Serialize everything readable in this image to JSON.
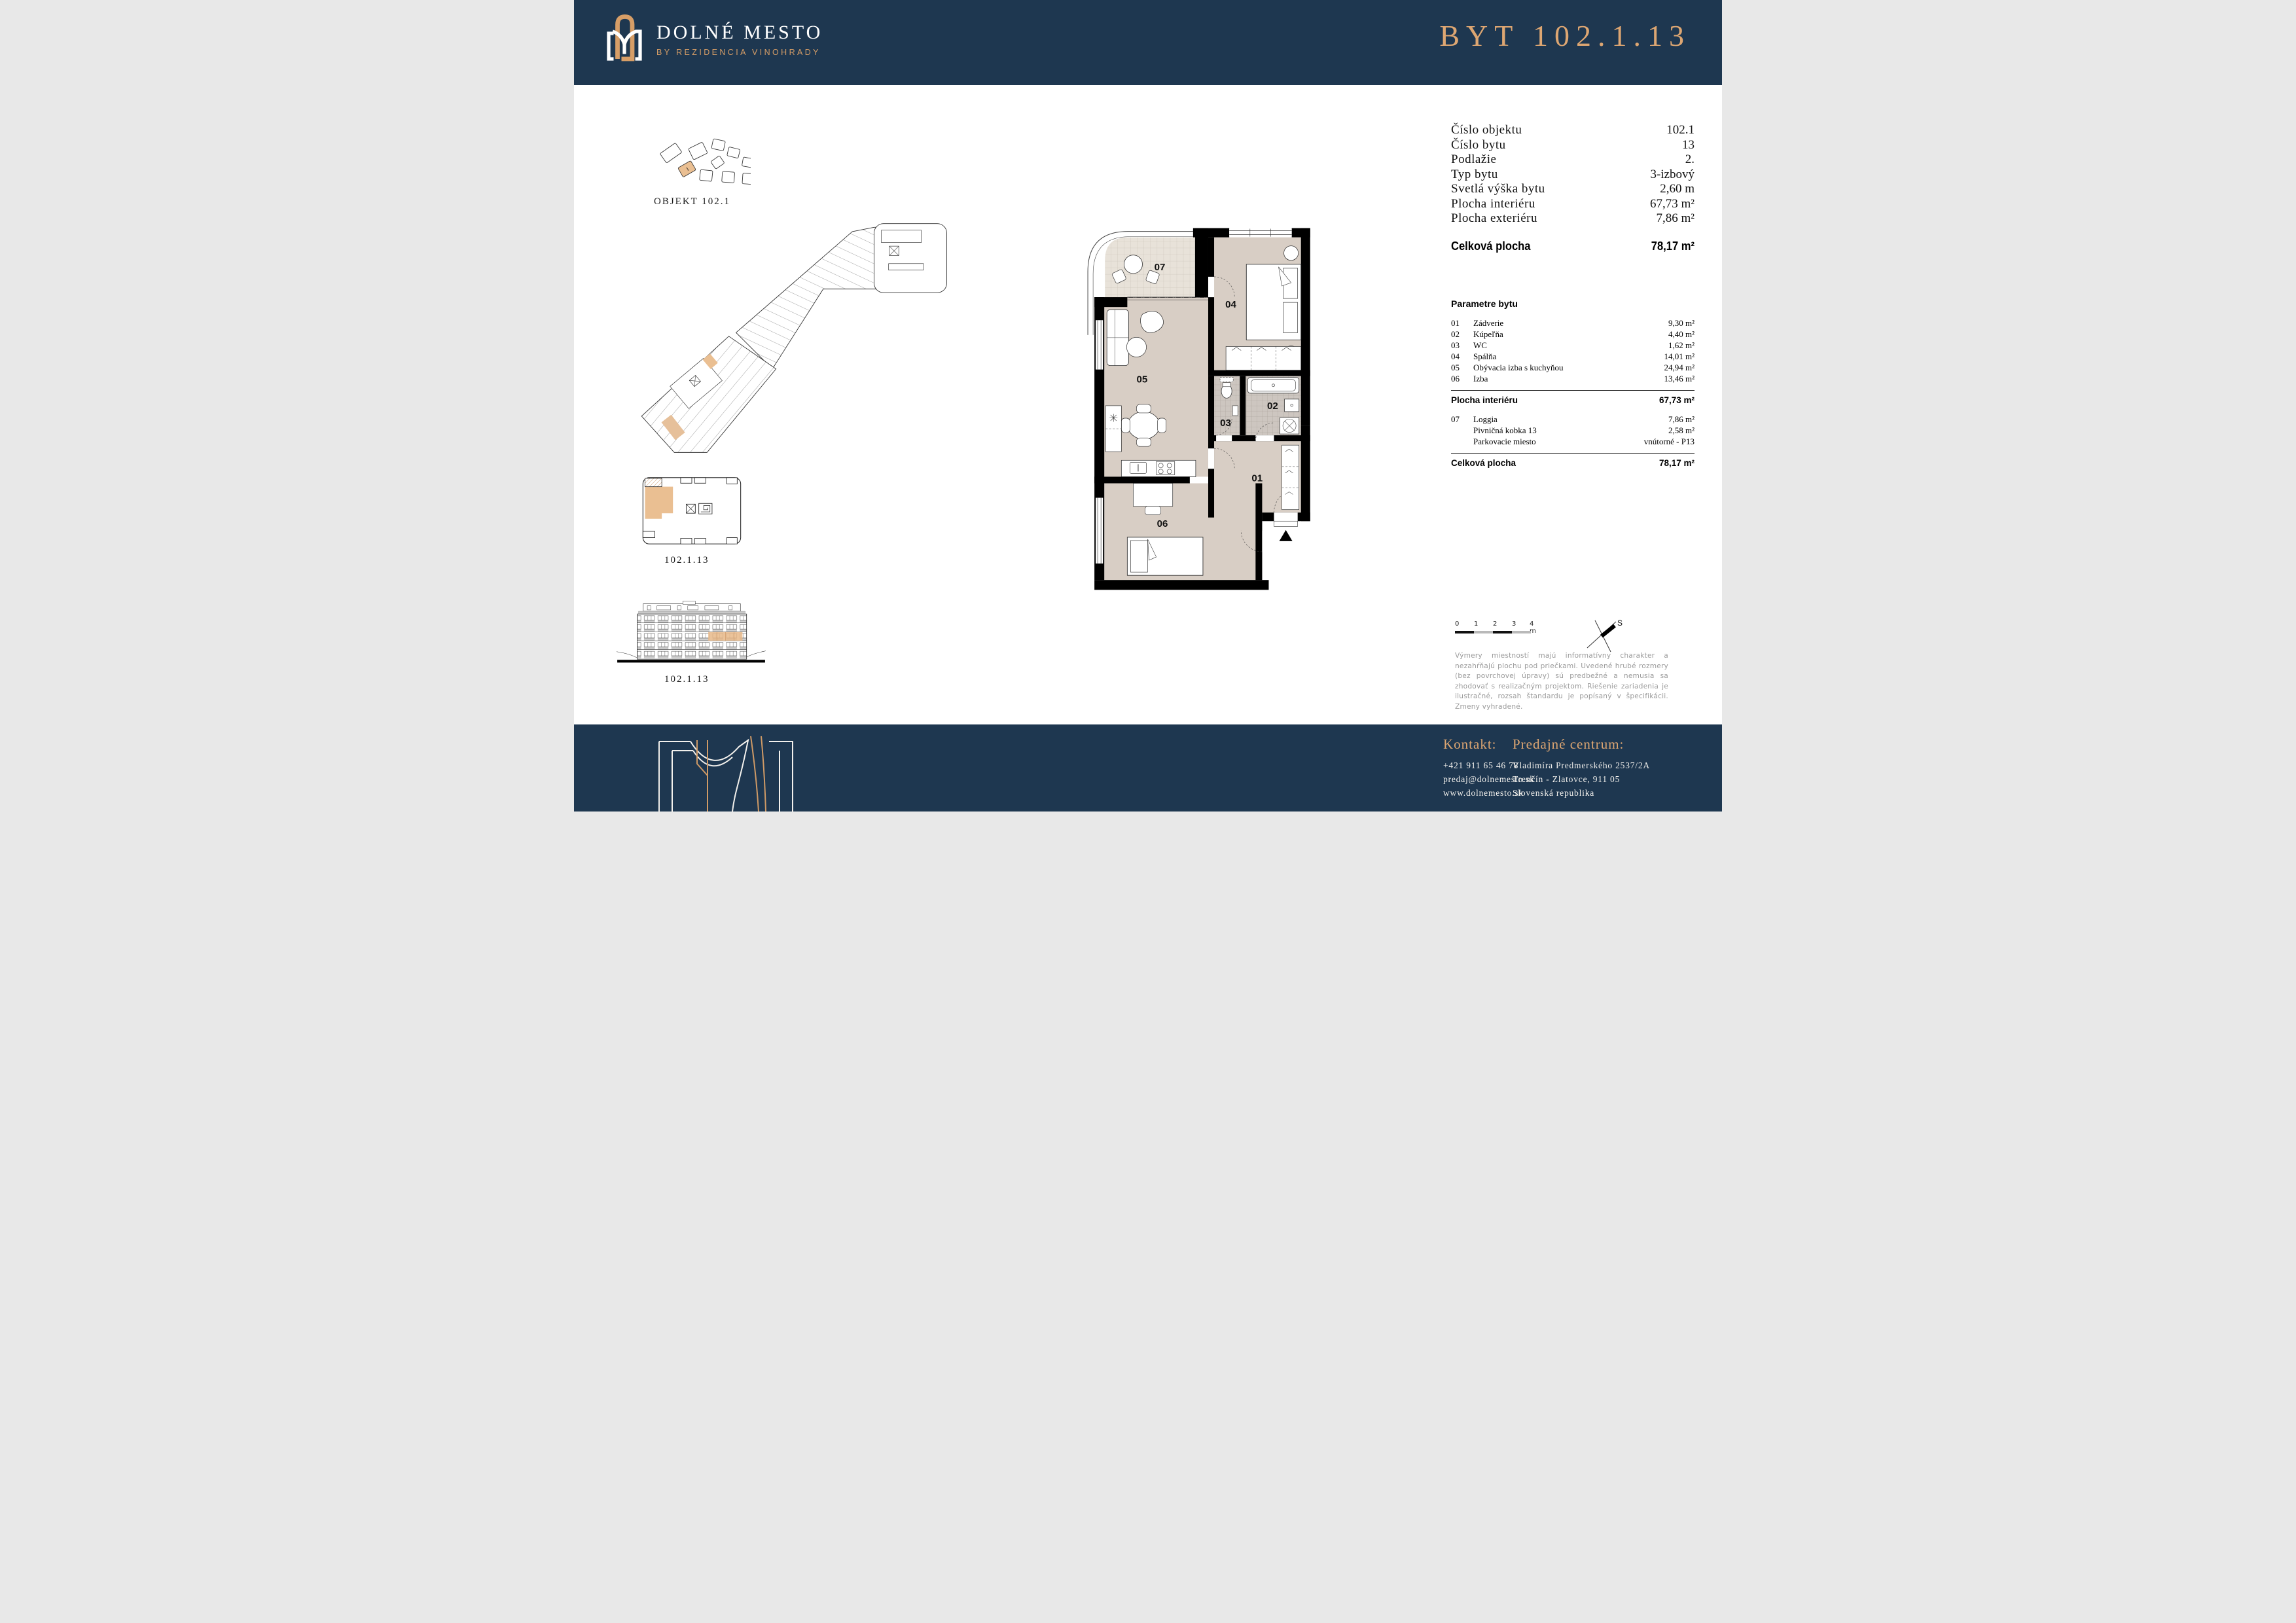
{
  "header": {
    "brand": "DOLNÉ MESTO",
    "brand_sub": "BY REZIDENCIA VINOHRADY",
    "title": "BYT 102.1.13"
  },
  "left": {
    "site_caption": "OBJEKT  102.1",
    "site_marker": "1",
    "floor_caption": "102.1.13",
    "elevation_caption": "102.1.13"
  },
  "summary": {
    "rows": [
      {
        "label": "Číslo objektu",
        "value": "102.1"
      },
      {
        "label": "Číslo bytu",
        "value": "13"
      },
      {
        "label": "Podlažie",
        "value": "2."
      },
      {
        "label": "Typ bytu",
        "value": "3-izbový"
      },
      {
        "label": "Svetlá výška bytu",
        "value": "2,60 m"
      },
      {
        "label": "Plocha interiéru",
        "value": "67,73 m²"
      },
      {
        "label": "Plocha exteriéru",
        "value": "7,86 m²"
      }
    ],
    "total_label": "Celková plocha",
    "total_value": "78,17 m²"
  },
  "parameters": {
    "heading": "Parametre bytu",
    "items": [
      {
        "num": "01",
        "label": "Zádverie",
        "value": "9,30 m²"
      },
      {
        "num": "02",
        "label": "Kúpeľňa",
        "value": "4,40 m²"
      },
      {
        "num": "03",
        "label": "WC",
        "value": "1,62 m²"
      },
      {
        "num": "04",
        "label": "Spálňa",
        "value": "14,01 m²"
      },
      {
        "num": "05",
        "label": "Obývacia izba s kuchyňou",
        "value": "24,94 m²"
      },
      {
        "num": "06",
        "label": "Izba",
        "value": "13,46 m²"
      }
    ],
    "interior_label": "Plocha interiéru",
    "interior_value": "67,73 m²",
    "extras": [
      {
        "num": "07",
        "label": "Loggia",
        "value": "7,86 m²"
      },
      {
        "num": "",
        "label": "Pivničná kobka 13",
        "value": "2,58 m²"
      },
      {
        "num": "",
        "label": "Parkovacie miesto",
        "value": "vnútorné - P13"
      }
    ],
    "total_label": "Celková plocha",
    "total_value": "78,17 m²"
  },
  "plan": {
    "rooms": [
      {
        "id": "01",
        "label": "01"
      },
      {
        "id": "02",
        "label": "02"
      },
      {
        "id": "03",
        "label": "03"
      },
      {
        "id": "04",
        "label": "04"
      },
      {
        "id": "05",
        "label": "05"
      },
      {
        "id": "06",
        "label": "06"
      },
      {
        "id": "07",
        "label": "07"
      }
    ]
  },
  "scalebar": {
    "labels": [
      "0",
      "1",
      "2",
      "3",
      "4 m"
    ]
  },
  "compass": {
    "north": "S"
  },
  "disclaimer": "Výmery miestností majú informatívny charakter a nezahŕňajú plochu pod priečkami. Uvedené hrubé rozmery (bez povrchovej úpravy) sú predbežné a nemusia sa zhodovať s realizačným projektom. Riešenie zariadenia je ilustračné, rozsah štandardu je popísaný v špecifikácii. Zmeny vyhradené.",
  "footer": {
    "contact_heading": "Kontakt:",
    "phone": "+421 911 65 46 78",
    "email": "predaj@dolnemesto.sk",
    "web": "www.dolnemesto.sk",
    "center_heading": "Predajné centrum:",
    "address1": "Vladimíra Predmerského 2537/2A",
    "address2": "Trenčín - Zlatovce, 911 05",
    "address3": "Slovenská republika"
  },
  "colors": {
    "navy": "#1e3750",
    "copper": "#dda672",
    "highlight": "#eabf92",
    "floor": "#d8cec5",
    "tile": "#cdc6c0"
  }
}
